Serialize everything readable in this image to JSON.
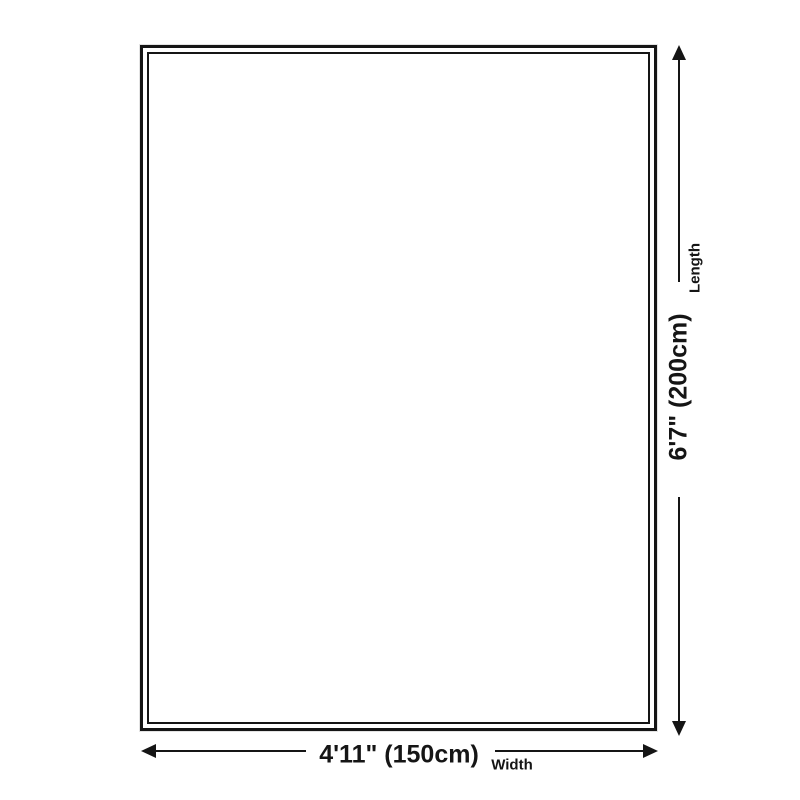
{
  "diagram": {
    "type": "product-size-diagram",
    "shape": "rectangle"
  },
  "dimensions": {
    "length": {
      "value": "6'7\" (200cm)",
      "label": "Length"
    },
    "width": {
      "value": "4'11\" (150cm)",
      "label": "Width"
    }
  },
  "icons": {
    "vertical_arrow": "double-headed-arrow-vertical",
    "horizontal_arrow": "double-headed-arrow-horizontal"
  },
  "colors": {
    "line": "#151515",
    "text": "#151515",
    "background": "#ffffff"
  }
}
